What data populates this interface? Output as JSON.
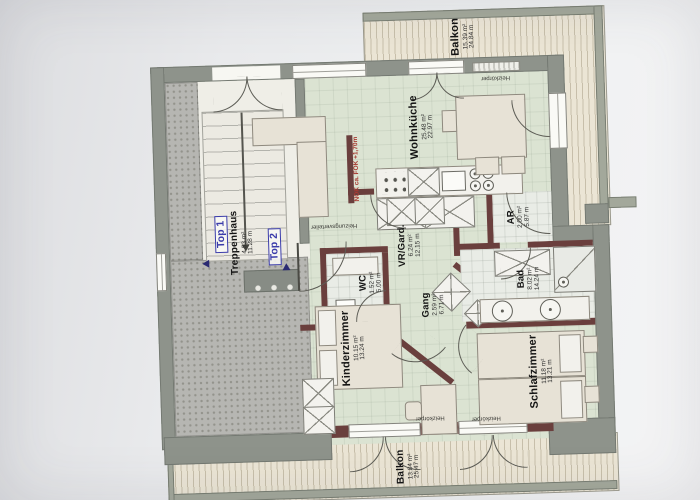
{
  "document": {
    "type": "apartment-floor-plan"
  },
  "units": {
    "top1": "Top 1",
    "top2": "Top 2"
  },
  "rooms": {
    "balkon_top": {
      "name": "Balkon",
      "area": "15.39 m²",
      "perimeter": "24.84 m"
    },
    "wohnkueche": {
      "name": "Wohnküche",
      "area": "25.48 m²",
      "perimeter": "22.97 m"
    },
    "treppenhaus": {
      "name": "Treppenhaus",
      "area": "4.53 m²",
      "perimeter": "11.28 m"
    },
    "vr_gard": {
      "name": "VR/Gard.",
      "area": "6.24 m²",
      "perimeter": "12.15 m"
    },
    "wc": {
      "name": "WC",
      "area": "1.52 m²",
      "perimeter": "5.00 m"
    },
    "gang": {
      "name": "Gang",
      "area": "2.59 m²",
      "perimeter": "6.71 m"
    },
    "bad": {
      "name": "Bad",
      "area": "8.02 m²",
      "perimeter": "14.24 m"
    },
    "ar": {
      "name": "AR",
      "area": "2.00 m²",
      "perimeter": "5.87 m"
    },
    "schlafzimmer": {
      "name": "Schlafzimmer",
      "area": "11.18 m²",
      "perimeter": "13.21 m"
    },
    "kinderzimmer": {
      "name": "Kinderzimmer",
      "area": "10.15 m²",
      "perimeter": "13.24 m"
    },
    "balkon_bottom": {
      "name": "Balkon",
      "area": "13.84 m²",
      "perimeter": "25.47 m"
    }
  },
  "annotations": {
    "heizungsverteiler": "Heizungsverteiler",
    "heizkoerper": "Heizkörper",
    "level_note": "NOK ca. FOK +1,70m"
  },
  "colors": {
    "unit_label_blue": "#3b3caa",
    "wall_interior": "#6a3f3d",
    "wall_exterior": "#8e938b",
    "room_floor_green": "#dbe3d2",
    "balcony_floor": "#ebe5d5",
    "annotation_red": "#a93a32"
  }
}
